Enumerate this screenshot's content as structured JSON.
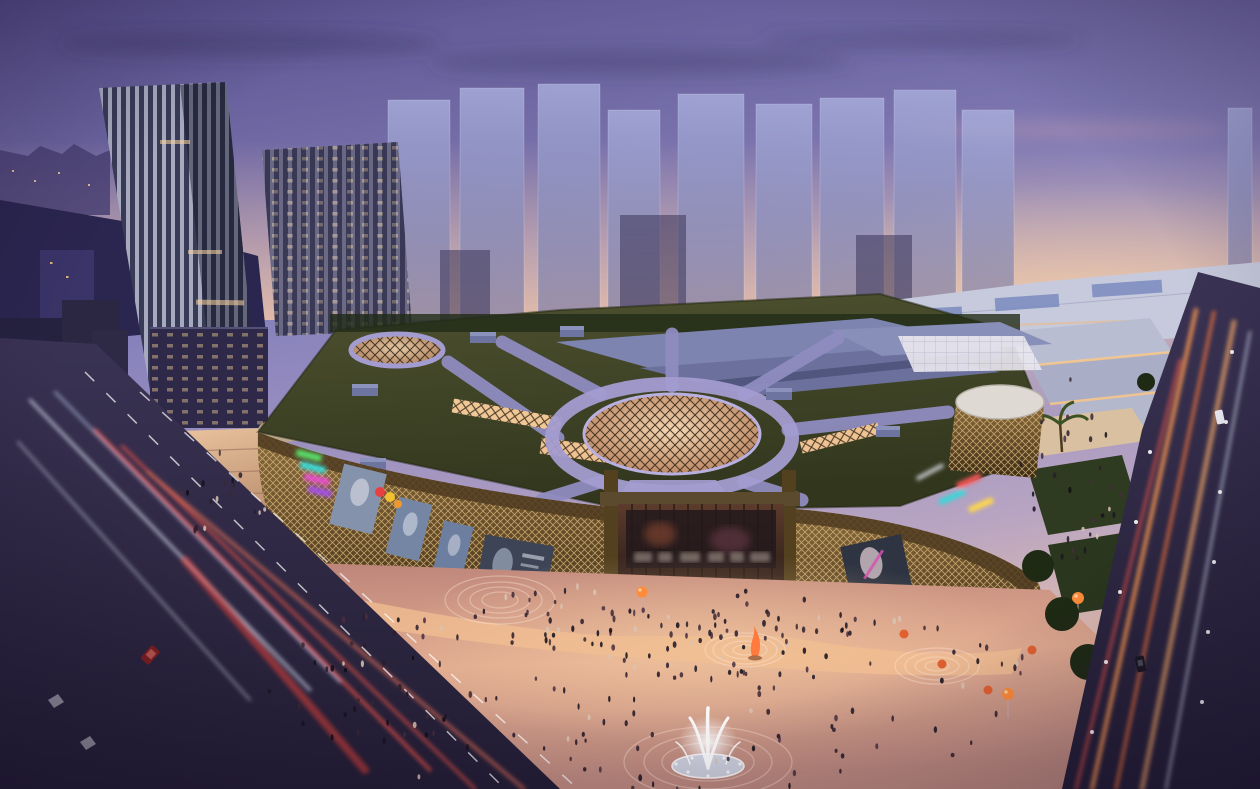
{
  "image": {
    "type": "architectural-rendering",
    "scene": "aerial-dusk-view-of-illuminated-shopping-mall-with-green-roof-plaza-fountain-and-towers"
  },
  "palette": {
    "sky-top": "#5c548f",
    "sky-mid": "#8e87c0",
    "sky-horizon": "#e9bfa8",
    "ghost-tower": "#9aa0d2",
    "tower-stripe-light": "#d4d9ea",
    "tower-stripe-dark": "#41445f",
    "roof-green": "#41452a",
    "roof-path": "#8f8cc0",
    "dome-glow": "#e6c0a0",
    "facade-bronze": "#6d5532",
    "facade-mesh": "#e0bd7c",
    "shop-glow": "#ffcf8a",
    "plaza-warm": "#d4a08c",
    "road-dark": "#2c2640",
    "trail-red": "#ff5848",
    "trail-white": "#e8f0ff",
    "trail-orange": "#ff9a50",
    "tree-dark": "#1e2a14",
    "tree-lit": "#6a4f22",
    "umbrella-red": "#c03828",
    "balloon-orange": "#ff8c3a",
    "neon-green": "#58e06a",
    "neon-cyan": "#39d8d8",
    "neon-magenta": "#e84fd0",
    "neon-purple": "#a44fe8",
    "neon-red": "#ff5a5a",
    "neon-yellow": "#ffd84a",
    "fountain-white": "#ffffff"
  },
  "scene": {
    "crowds": {
      "plaza": 150,
      "entrance": 35,
      "terrace": 45,
      "promenade": 30,
      "stairs": 18
    }
  }
}
